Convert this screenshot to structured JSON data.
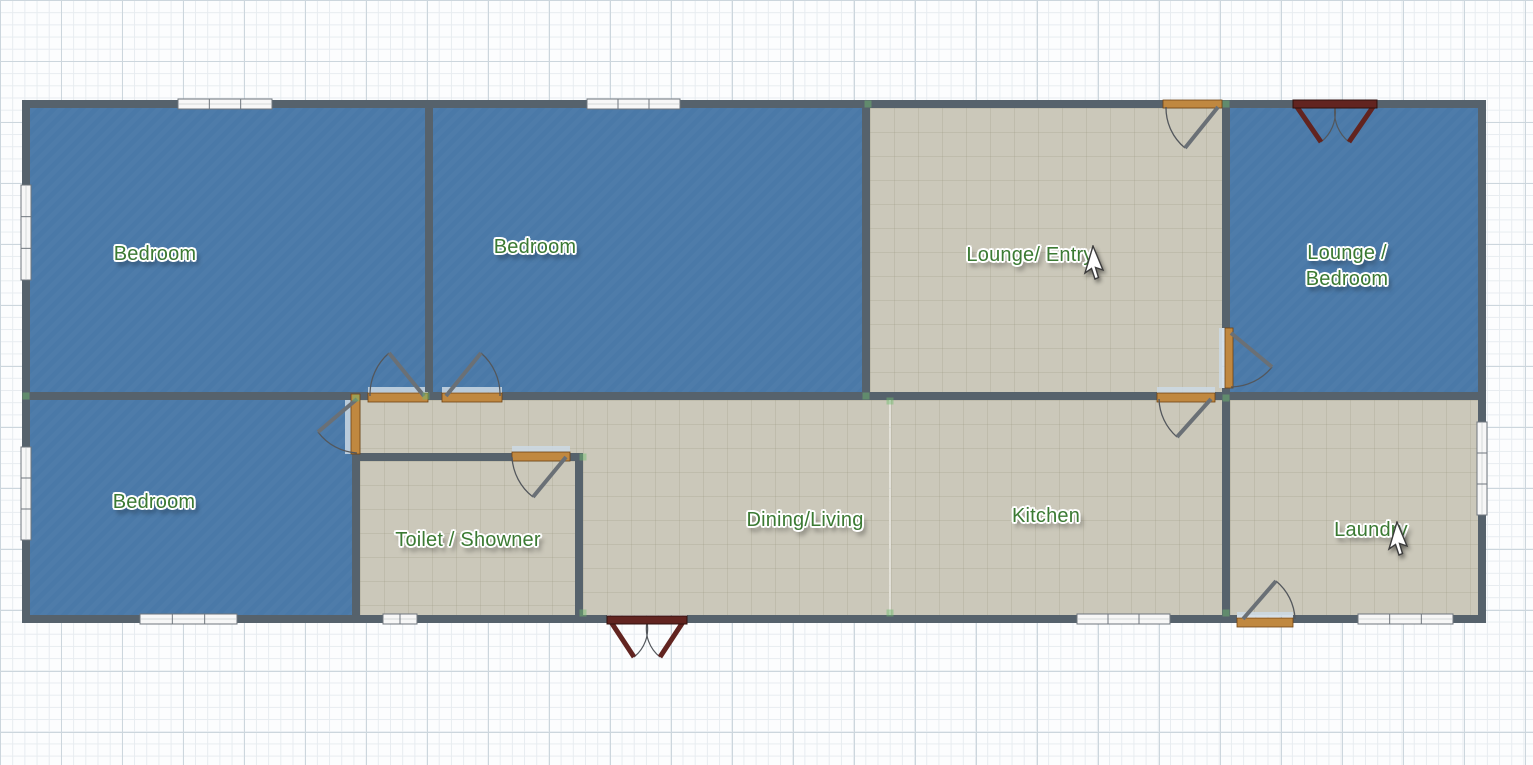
{
  "canvas": {
    "width": 1533,
    "height": 765,
    "description": "Floor plan editor canvas on graph-paper grid"
  },
  "palette": {
    "grid_bg": "#fcfdfe",
    "grid_minor": "#e7ecf0",
    "grid_major": "#ccd6dd",
    "wall": "#56626c",
    "floor_blue": "#4a79a8",
    "floor_gray": "#cbc8ba",
    "divider": "rgba(222,219,205,0.75)",
    "threshold": "#ccd9e4",
    "window_fill": "#f7f7f7",
    "window_border": "#6f767d",
    "window_midline": "#d5d8da",
    "door_sill": "#c08840",
    "door_sill_border": "#6e4312",
    "door_leaf": "#6a7076",
    "door_arc": "#53575c",
    "french_door": "#622420",
    "french_door_border": "#30100d",
    "label_color": "#3b7a33",
    "handle": "rgba(111,191,111,0.45)",
    "cursor_fill": "#ffffff",
    "cursor_stroke": "#3c3c3c"
  },
  "rooms": [
    {
      "id": "bedroom-1",
      "label": "Bedroom",
      "floor": "blue",
      "rect": [
        30,
        108,
        395,
        284
      ],
      "lx": 155,
      "ly": 254
    },
    {
      "id": "bedroom-2",
      "label": "Bedroom",
      "floor": "blue",
      "rect": [
        433,
        108,
        429,
        284
      ],
      "lx": 535,
      "ly": 247
    },
    {
      "id": "lounge-entry",
      "label": "Lounge/ Entry",
      "floor": "gray",
      "rect": [
        870,
        108,
        352,
        284
      ],
      "lx": 1030,
      "ly": 255
    },
    {
      "id": "lounge-bedroom",
      "label": "Lounge /\nBedroom",
      "floor": "blue",
      "rect": [
        1230,
        108,
        248,
        284
      ],
      "lx": 1347,
      "ly": 266
    },
    {
      "id": "bedroom-3",
      "label": "Bedroom",
      "floor": "blue",
      "rect": [
        30,
        400,
        322,
        215
      ],
      "lx": 154,
      "ly": 502
    },
    {
      "id": "hallway",
      "label": "",
      "floor": "gray",
      "rect": [
        360,
        400,
        223,
        61
      ]
    },
    {
      "id": "toilet-shower",
      "label": "Toilet / Showner",
      "floor": "gray",
      "rect": [
        360,
        461,
        215,
        154
      ],
      "lx": 468,
      "ly": 540
    },
    {
      "id": "dining-living",
      "label": "Dining/Living",
      "floor": "gray",
      "rect": [
        583,
        400,
        306,
        215
      ],
      "lx": 805,
      "ly": 520
    },
    {
      "id": "kitchen",
      "label": "Kitchen",
      "floor": "gray",
      "rect": [
        891,
        400,
        331,
        215
      ],
      "lx": 1046,
      "ly": 516
    },
    {
      "id": "laundry",
      "label": "Laundry",
      "floor": "gray",
      "rect": [
        1230,
        400,
        248,
        215
      ],
      "lx": 1371,
      "ly": 530
    }
  ],
  "walls": [
    [
      22,
      100,
      1141,
      8
    ],
    [
      1222,
      100,
      71,
      8
    ],
    [
      1377,
      100,
      109,
      8
    ],
    [
      22,
      615,
      585,
      8
    ],
    [
      687,
      615,
      550,
      8
    ],
    [
      1293,
      615,
      193,
      8
    ],
    [
      22,
      100,
      8,
      523
    ],
    [
      1478,
      100,
      8,
      523
    ],
    [
      22,
      392,
      346,
      8
    ],
    [
      428,
      392,
      14,
      8
    ],
    [
      502,
      392,
      655,
      8
    ],
    [
      1215,
      392,
      271,
      8
    ],
    [
      425,
      108,
      8,
      284
    ],
    [
      862,
      108,
      8,
      284
    ],
    [
      1222,
      108,
      8,
      220
    ],
    [
      1222,
      388,
      8,
      4
    ],
    [
      1222,
      400,
      8,
      215
    ],
    [
      352,
      453,
      8,
      162
    ],
    [
      352,
      453,
      160,
      8
    ],
    [
      570,
      453,
      13,
      8
    ],
    [
      575,
      453,
      8,
      162
    ]
  ],
  "divider": [
    889,
    400,
    2,
    215
  ],
  "windows": [
    {
      "r": [
        178,
        99,
        94,
        10
      ],
      "o": "h",
      "p": 3
    },
    {
      "r": [
        587,
        99,
        93,
        10
      ],
      "o": "h",
      "p": 3
    },
    {
      "r": [
        21,
        185,
        10,
        95
      ],
      "o": "v",
      "p": 3
    },
    {
      "r": [
        21,
        447,
        10,
        93
      ],
      "o": "v",
      "p": 3
    },
    {
      "r": [
        140,
        614,
        97,
        10
      ],
      "o": "h",
      "p": 3
    },
    {
      "r": [
        383,
        614,
        34,
        10
      ],
      "o": "h",
      "p": 2
    },
    {
      "r": [
        1077,
        614,
        93,
        10
      ],
      "o": "h",
      "p": 3
    },
    {
      "r": [
        1358,
        614,
        95,
        10
      ],
      "o": "h",
      "p": 3
    },
    {
      "r": [
        1477,
        422,
        10,
        93
      ],
      "o": "v",
      "p": 3
    }
  ],
  "doors": [
    {
      "id": "door-bedroom-1",
      "sill": [
        368,
        393,
        60,
        9
      ],
      "th": [
        368,
        387,
        60,
        7
      ],
      "leaf": [
        424,
        396,
        389,
        353
      ],
      "arc": [
        370,
        396,
        55,
        389,
        353,
        1
      ]
    },
    {
      "id": "door-bedroom-2",
      "sill": [
        442,
        393,
        60,
        9
      ],
      "th": [
        442,
        387,
        60,
        7
      ],
      "leaf": [
        446,
        396,
        481,
        353
      ],
      "arc": [
        500,
        396,
        55,
        481,
        353,
        0
      ]
    },
    {
      "id": "door-bedroom-3",
      "sill": [
        351,
        394,
        9,
        60
      ],
      "th": [
        345,
        395,
        6,
        59
      ],
      "leaf": [
        357,
        399,
        318,
        432
      ],
      "arc": [
        357,
        453,
        52,
        318,
        432,
        1
      ]
    },
    {
      "id": "door-toilet",
      "sill": [
        512,
        452,
        58,
        9
      ],
      "th": [
        512,
        446,
        58,
        6
      ],
      "leaf": [
        566,
        457,
        533,
        497
      ],
      "arc": [
        512,
        457,
        54,
        533,
        497,
        0
      ]
    },
    {
      "id": "door-kitchen",
      "sill": [
        1157,
        393,
        58,
        9
      ],
      "th": [
        1157,
        387,
        58,
        6
      ],
      "leaf": [
        1211,
        399,
        1177,
        437
      ],
      "arc": [
        1159,
        399,
        52,
        1177,
        437,
        0
      ]
    },
    {
      "id": "door-lounge-entry",
      "sill": [
        1163,
        100,
        59,
        8
      ],
      "th": null,
      "leaf": [
        1218,
        107,
        1185,
        148
      ],
      "arc": [
        1166,
        107,
        52,
        1185,
        148,
        0
      ]
    },
    {
      "id": "door-lounge-bedroom",
      "sill": [
        1225,
        328,
        8,
        60
      ],
      "th": [
        1219,
        328,
        6,
        60
      ],
      "leaf": [
        1231,
        333,
        1272,
        367
      ],
      "arc": [
        1231,
        387,
        54,
        1272,
        367,
        0
      ]
    },
    {
      "id": "door-laundry",
      "sill": [
        1237,
        618,
        56,
        9
      ],
      "th": [
        1237,
        612,
        56,
        5
      ],
      "leaf": [
        1243,
        619,
        1276,
        581
      ],
      "arc": [
        1295,
        619,
        52,
        1276,
        581,
        0
      ]
    }
  ],
  "french_doors": [
    {
      "id": "french-door-lounge-bedroom",
      "lintel": [
        1293,
        100,
        84,
        8
      ],
      "leaves": [
        [
          1297,
          107,
          1321,
          142
        ],
        [
          1373,
          107,
          1349,
          142
        ]
      ],
      "arcs": [
        [
          1335,
          107,
          38,
          1321,
          142,
          1
        ],
        [
          1335,
          107,
          38,
          1349,
          142,
          0
        ]
      ]
    },
    {
      "id": "french-door-dining-living",
      "lintel": [
        607,
        616,
        80,
        8
      ],
      "leaves": [
        [
          611,
          622,
          634,
          657
        ],
        [
          683,
          622,
          660,
          657
        ]
      ],
      "arcs": [
        [
          647,
          622,
          36,
          634,
          657,
          1
        ],
        [
          647,
          622,
          36,
          660,
          657,
          0
        ]
      ]
    }
  ],
  "handles": [
    [
      426,
      396
    ],
    [
      866,
      396
    ],
    [
      890,
      401
    ],
    [
      890,
      613
    ],
    [
      868,
      104
    ],
    [
      1226,
      104
    ],
    [
      356,
      398
    ],
    [
      583,
      457
    ],
    [
      1226,
      398
    ],
    [
      26,
      396
    ],
    [
      583,
      613
    ],
    [
      1226,
      613
    ]
  ],
  "cursors": [
    {
      "id": "pointer-cursor-lounge-entry",
      "x": 1093,
      "y": 246
    },
    {
      "id": "pointer-cursor-laundry",
      "x": 1397,
      "y": 522
    }
  ]
}
